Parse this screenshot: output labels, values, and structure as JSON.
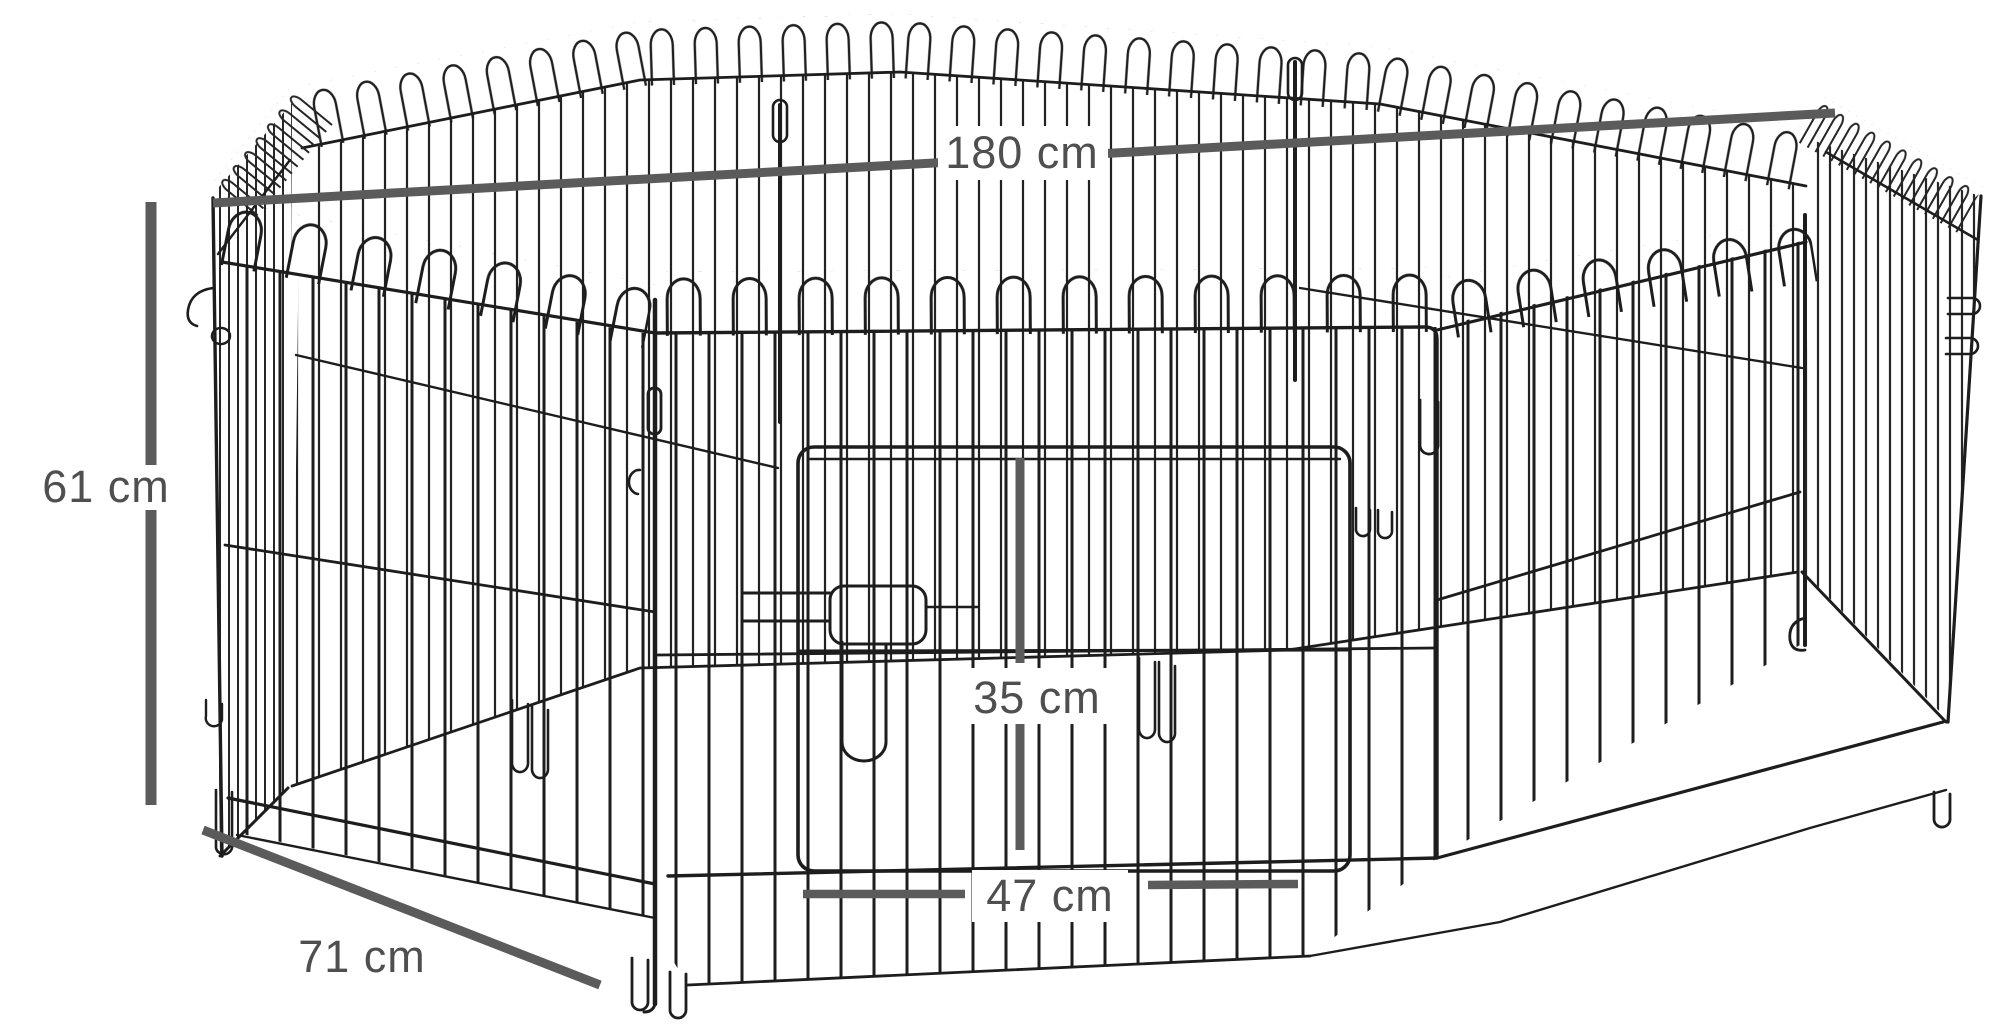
{
  "page": {
    "background_color": "#ffffff"
  },
  "diagram": {
    "subject": "octagonal 8-panel wire pet playpen with front door, line drawing",
    "wire_color": "#1d1d1d",
    "dimension_color": "#5b5b5b",
    "label_text_color": "#4f4f4f",
    "dimensions": {
      "overall_width": {
        "label": "180 cm"
      },
      "panel_height": {
        "label": "61 cm"
      },
      "door_height": {
        "label": "35 cm"
      },
      "door_width": {
        "label": "47 cm"
      },
      "panel_width": {
        "label": "71 cm"
      }
    }
  }
}
